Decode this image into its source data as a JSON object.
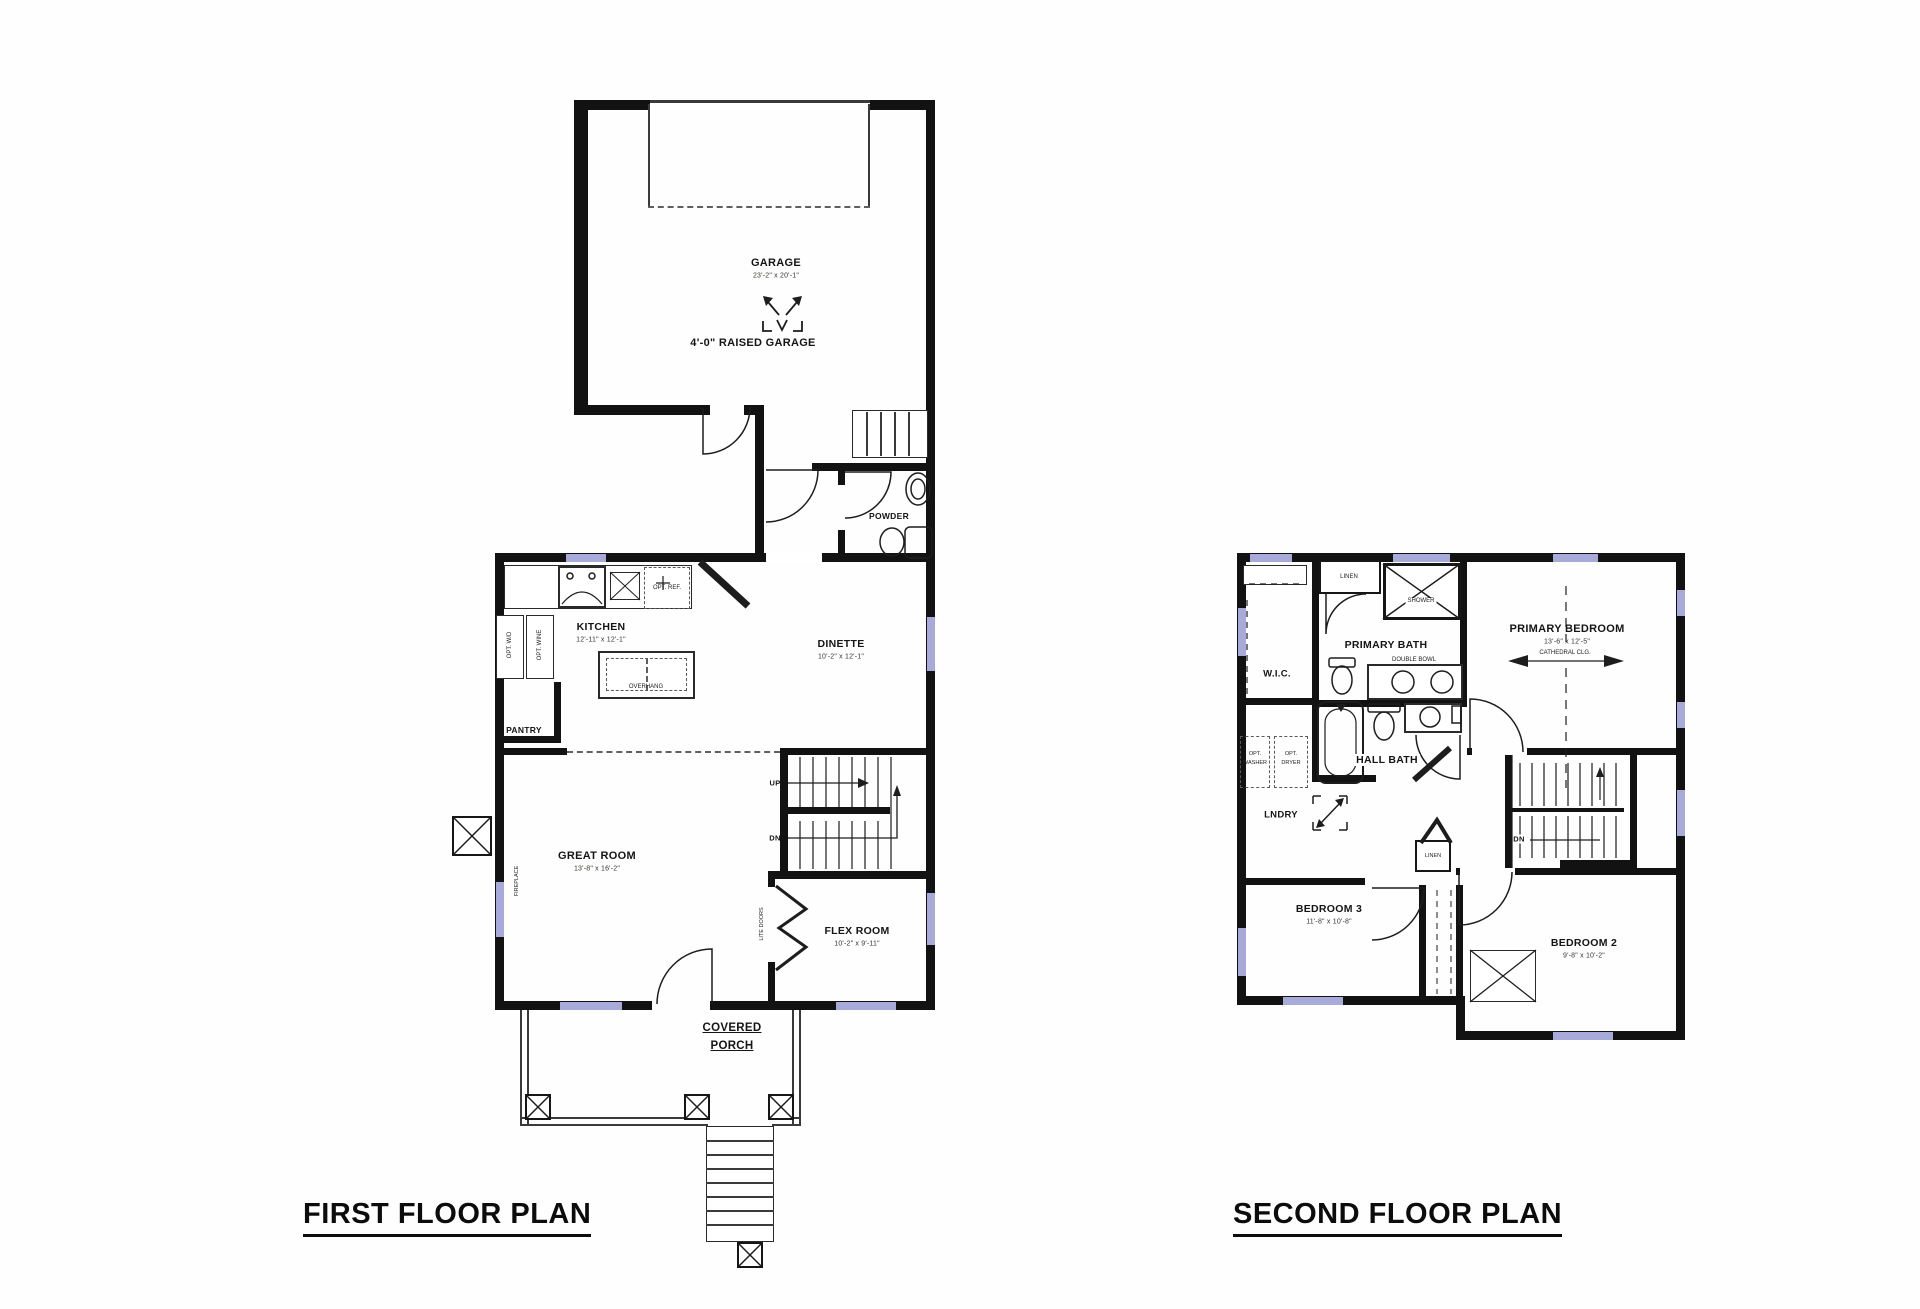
{
  "colors": {
    "wall": "#121212",
    "window": "#a8aada",
    "detail_line": "#3a3a3a"
  },
  "first_floor": {
    "title": "FIRST FLOOR PLAN",
    "garage": {
      "name": "GARAGE",
      "dims": "23'-2\" x 20'-1\""
    },
    "raised_garage_note": "4'-0\" RAISED GARAGE",
    "powder": "POWDER",
    "kitchen": {
      "name": "KITCHEN",
      "dims": "12'-11\" x 12'-1\""
    },
    "opt_ref": "OPT. REF.",
    "opt_wd": "OPT. W/D",
    "opt_wine": "OPT. WINE",
    "overhang": "OVERHANG",
    "pantry": "PANTRY",
    "dinette": {
      "name": "DINETTE",
      "dims": "10'-2\" x 12'-1\""
    },
    "great_room": {
      "name": "GREAT ROOM",
      "dims": "13'-8\" x 16'-2\""
    },
    "fireplace": "FIREPLACE",
    "up": "UP",
    "dn": "DN",
    "lite_doors": "LITE DOORS",
    "flex_room": {
      "name": "FLEX ROOM",
      "dims": "10'-2\" x 9'-11\""
    },
    "covered_porch_line1": "COVERED",
    "covered_porch_line2": "PORCH"
  },
  "second_floor": {
    "title": "SECOND FLOOR PLAN",
    "wic": "W.I.C.",
    "linen_bath": "LINEN",
    "shower": "SHOWER",
    "primary_bath": "PRIMARY BATH",
    "double_bowl": "DOUBLE BOWL",
    "primary_bedroom": {
      "name": "PRIMARY BEDROOM",
      "dims": "13'-6\" x 12'-5\"",
      "ceiling": "CATHEDRAL CLG."
    },
    "hall_bath": "HALL BATH",
    "opt_washer_l1": "OPT.",
    "opt_washer_l2": "WASHER",
    "opt_dryer_l1": "OPT.",
    "opt_dryer_l2": "DRYER",
    "lndry": "LNDRY",
    "dn": "DN",
    "linen_hall": "LINEN",
    "bedroom3": {
      "name": "BEDROOM 3",
      "dims": "11'-8\" x 10'-8\""
    },
    "bedroom2": {
      "name": "BEDROOM 2",
      "dims": "9'-8\" x 10'-2\""
    }
  }
}
